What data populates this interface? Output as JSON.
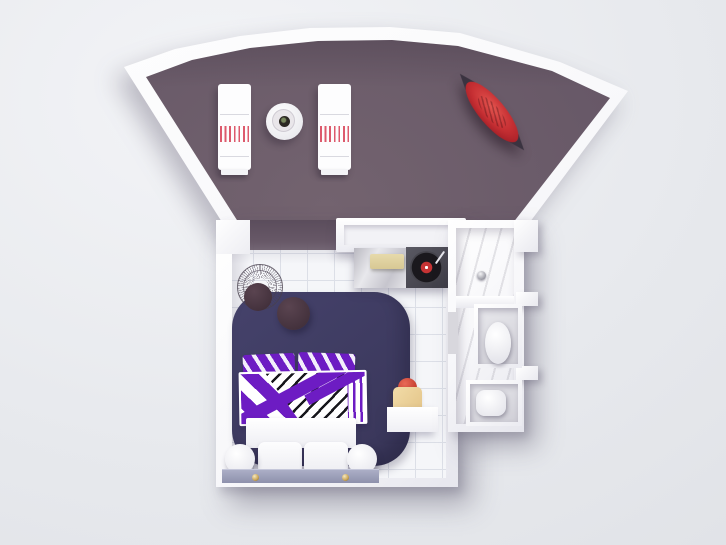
{
  "scene": {
    "title": "Top-down 3D render of a studio suite: fan-shaped terrace with loungers and kayak above a tiled bedroom with graphic purple bed and marble bathroom"
  },
  "palette": {
    "bg1": "#f3f4f7",
    "bg2": "#e7e9ed",
    "bg3": "#dfe1e6",
    "wall": "#f6f6f9",
    "terrace-hi": "#73636f",
    "terrace-mid": "#675867",
    "terrace-lo": "#5b4d5c",
    "tile": "#f5f6f9",
    "tile-line": "#dcdfe7",
    "rug-hi": "#45426b",
    "rug-lo": "#393659",
    "plum": "#43313c",
    "plum-hi": "#5a4450",
    "purple": "#6d1cc3",
    "ink": "#17171c",
    "red-stripe": "#dd5a6d",
    "kayak-hi": "#e4554f",
    "kayak-mid": "#c62f33",
    "kayak-lo": "#8e141f",
    "kayak-tip": "#3a3340",
    "tray": "#d8c894",
    "tan": "#e3c488",
    "tan-hi": "#f2dca8",
    "coral": "#c23a2c",
    "coral-hi": "#e86a57",
    "bench": "#8e91ac",
    "bench-hi": "#abaec6",
    "gold": "#c9a455",
    "vinyl": "#1a181d",
    "vinyl-label": "#c63334"
  },
  "objects": {
    "terrace": {
      "label": "Fan-shaped terrace with mauve deck"
    },
    "lounger_left": {
      "label": "Sun lounger with red striped cushion"
    },
    "lounger_right": {
      "label": "Sun lounger with red striped cushion"
    },
    "side_table": {
      "label": "Round terrace table with plate"
    },
    "kayak": {
      "label": "Red kayak"
    },
    "bedroom": {
      "label": "Bedroom with white tiled floor"
    },
    "doorway": {
      "label": "Open doorway to terrace"
    },
    "closet": {
      "label": "Wardrobe unit"
    },
    "counter": {
      "label": "Marble sideboard"
    },
    "tray": {
      "label": "Serving tray"
    },
    "turntable": {
      "label": "Turntable with vinyl record"
    },
    "shower": {
      "label": "Marble shower room"
    },
    "drain": {
      "label": "Shower drain"
    },
    "bidet": {
      "label": "Bidet"
    },
    "toilet": {
      "label": "Toilet"
    },
    "rug": {
      "label": "Navy area rug"
    },
    "wire_chair": {
      "label": "Wire chair"
    },
    "pouf": {
      "label": "Plum pouf"
    },
    "bed": {
      "label": "Double bed with purple graphic duvet"
    },
    "bench": {
      "label": "Low bench with brass knobs"
    },
    "desk": {
      "label": "Wall shelf with tan stool and coral ball"
    }
  }
}
